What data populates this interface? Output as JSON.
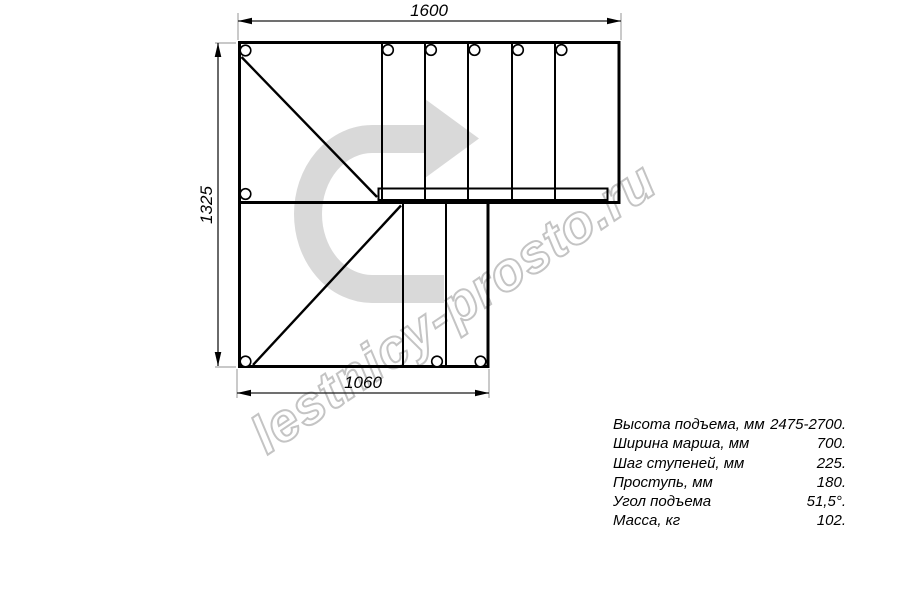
{
  "drawing": {
    "dimensions": {
      "top": "1600",
      "left": "1325",
      "bottom": "1060"
    },
    "watermark": "lestnicy-prosto.ru",
    "colors": {
      "line": "#000000",
      "dimension_line": "#1a1a1a",
      "extension_line": "#a6a6a6",
      "direction_arrow": "#d9d9d9",
      "watermark_stroke": "#c4c4c4"
    }
  },
  "specs": {
    "rows": [
      {
        "label": "Высота подъема, мм",
        "value": "2475-2700."
      },
      {
        "label": "Ширина марша, мм",
        "value": "700."
      },
      {
        "label": "Шаг ступеней, мм",
        "value": "225."
      },
      {
        "label": "Проступь, мм",
        "value": "180."
      },
      {
        "label": "Угол подъема",
        "value": "51,5°."
      },
      {
        "label": "Масса, кг",
        "value": "102."
      }
    ]
  }
}
